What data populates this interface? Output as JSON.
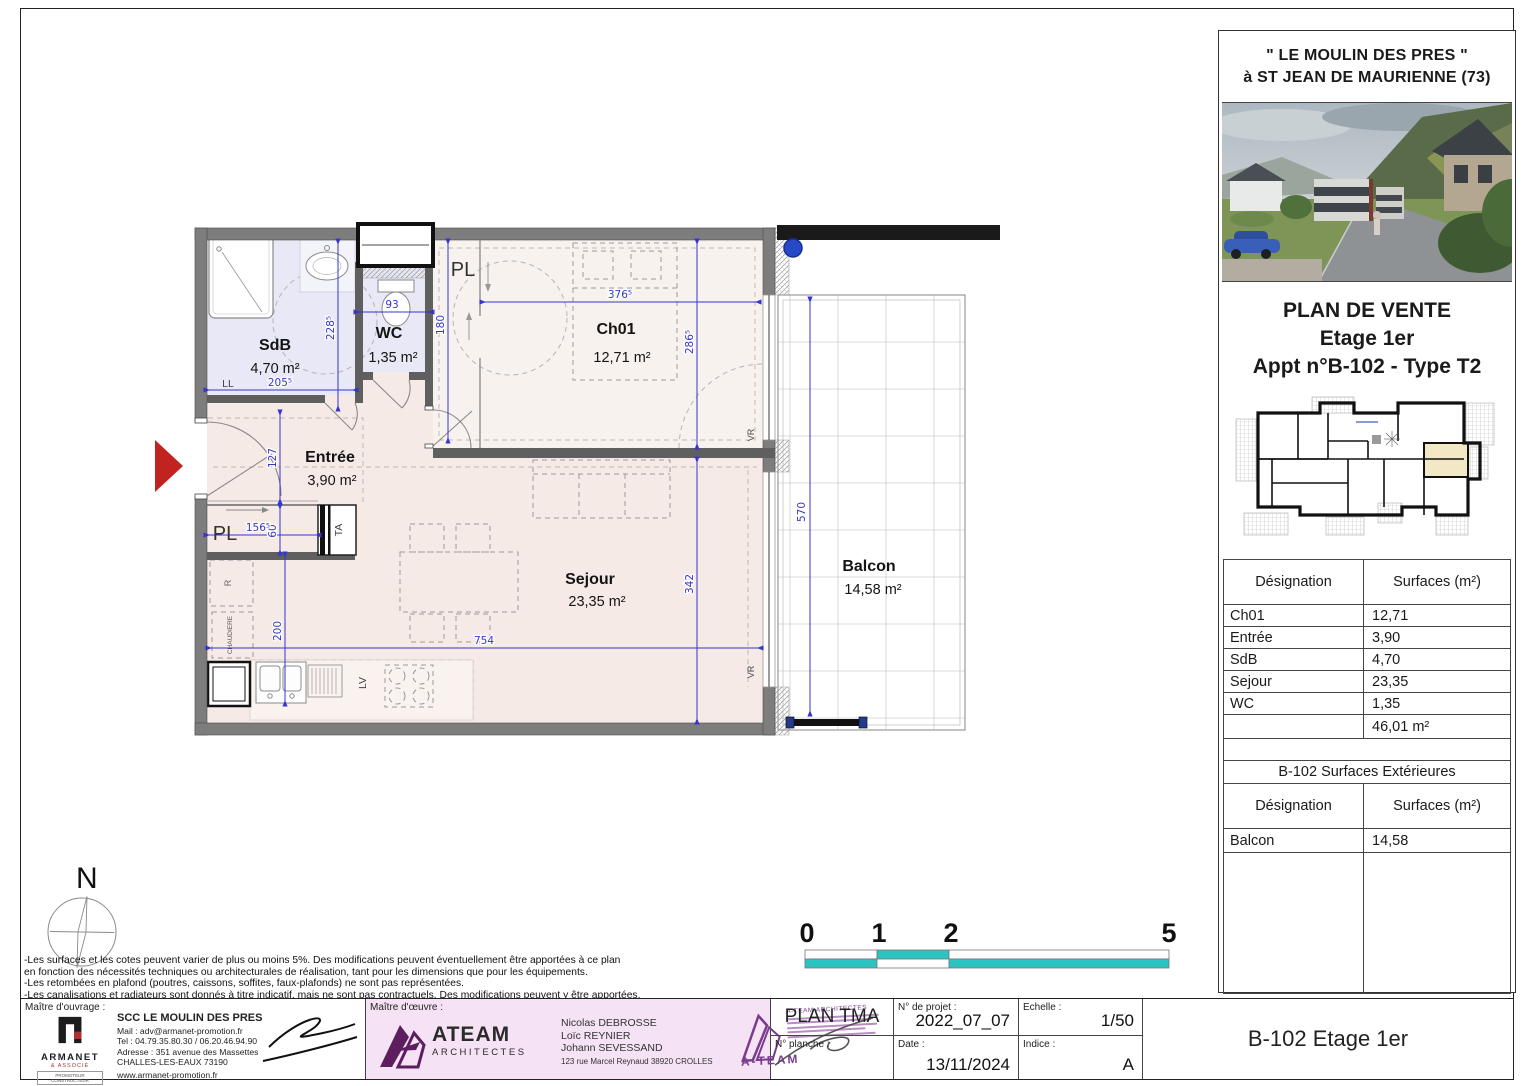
{
  "colors": {
    "dim_blue": "#3535cf",
    "scale_teal": "#2cc3c3",
    "arrow_red": "#c12420",
    "wet_room_fill": "#e8e8f6",
    "living_fill": "#f6eae7",
    "bedroom_fill": "#f8f2ef",
    "unit_highlight": "#f2e8c6",
    "architect_purple": "#5c1e5e"
  },
  "panel": {
    "title_line1": "\" LE MOULIN DES PRES \"",
    "title_line2": "à ST JEAN DE MAURIENNE (73)",
    "sale_title": "PLAN DE VENTE",
    "sale_floor": "Etage 1er",
    "sale_apt": "Appt n°B-102 - Type T2",
    "surfaces": {
      "col_designation": "Désignation",
      "col_surfaces": "Surfaces (m²)",
      "rows": [
        {
          "label": "Ch01",
          "value": "12,71"
        },
        {
          "label": "Entrée",
          "value": "3,90"
        },
        {
          "label": "SdB",
          "value": "4,70"
        },
        {
          "label": "Sejour",
          "value": "23,35"
        },
        {
          "label": "WC",
          "value": "1,35"
        }
      ],
      "total": "46,01 m²"
    },
    "exterior": {
      "title": "B-102 Surfaces Extérieures",
      "col_designation": "Désignation",
      "col_surfaces": "Surfaces (m²)",
      "rows": [
        {
          "label": "Balcon",
          "value": "14,58"
        }
      ]
    }
  },
  "plan": {
    "rooms": {
      "sdb": {
        "name": "SdB",
        "area": "4,70 m²"
      },
      "wc": {
        "name": "WC",
        "area": "1,35 m²"
      },
      "ch01": {
        "name": "Ch01",
        "area": "12,71 m²"
      },
      "entree": {
        "name": "Entrée",
        "area": "3,90 m²"
      },
      "sejour": {
        "name": "Sejour",
        "area": "23,35 m²"
      },
      "balcon": {
        "name": "Balcon",
        "area": "14,58 m²"
      }
    },
    "labels": {
      "pl_top": "PL",
      "pl_bottom": "PL",
      "ll": "LL",
      "ta": "TA",
      "r": "R",
      "lv": "LV",
      "chaudiere": "CHAUDIERE",
      "vr_top": "VR",
      "vr_bottom": "VR"
    },
    "dims": {
      "d228": "228⁵",
      "d93": "93",
      "d180": "180",
      "d376": "376⁵",
      "d286": "286⁵",
      "d342": "342",
      "d205": "205⁵",
      "d127": "127",
      "d60": "60",
      "d156": "156⁵",
      "d200": "200",
      "d754": "754",
      "d570": "570"
    }
  },
  "north_label": "N",
  "scale_bar": {
    "t0": "0",
    "t1": "1",
    "t2": "2",
    "t5": "5"
  },
  "notes": [
    "-Les surfaces et les cotes peuvent varier de plus ou moins 5%. Des modifications peuvent éventuellement être apportées à ce plan",
    "en fonction des nécessités techniques ou architecturales de réalisation, tant pour les dimensions que pour les équipements.",
    "-Les retombées en plafond (poutres, caissons, soffites, faux-plafonds) ne sont pas représentées.",
    "-Les canalisations et radiateurs sont donnés à titre indicatif, mais ne sont pas contractuels. Des modifications peuvent y être apportées."
  ],
  "title_block": {
    "owner_label": "Maître d'ouvrage :",
    "owner": {
      "logo_text": "ARMANET",
      "logo_sub": "& ASSOCIÉ",
      "logo_tag": "PROMOTEUR CONSTRUCTEUR",
      "name": "SCC LE MOULIN DES PRES",
      "mail": "Mail : adv@armanet-promotion.fr",
      "tel": "Tel : 04.79.35.80.30 / 06.20.46.94.90",
      "address": "Adresse : 351 avenue des Massettes",
      "city": "CHALLES-LES-EAUX 73190",
      "web": "www.armanet-promotion.fr"
    },
    "architect_label": "Maître d'œuvre :",
    "architect": {
      "logo_text": "ATEAM",
      "logo_sub": "ARCHITECTES",
      "name1": "Nicolas DEBROSSE",
      "name2": "Loïc REYNIER",
      "name3": "Johann SEVESSAND",
      "address": "123 rue Marcel Reynaud 38920 CROLLES",
      "stamp_title": "A-TEAM ARCHITECTES",
      "stamp_name": "A-TEAM"
    },
    "plan_name": "PLAN TMA",
    "planche_label": "N° planche :",
    "project_label": "N° de projet :",
    "project_value": "2022_07_07",
    "date_label": "Date :",
    "date_value": "13/11/2024",
    "scale_label": "Echelle :",
    "scale_value": "1/50",
    "index_label": "Indice :",
    "index_value": "A",
    "sheet_title": "B-102 Etage 1er"
  }
}
